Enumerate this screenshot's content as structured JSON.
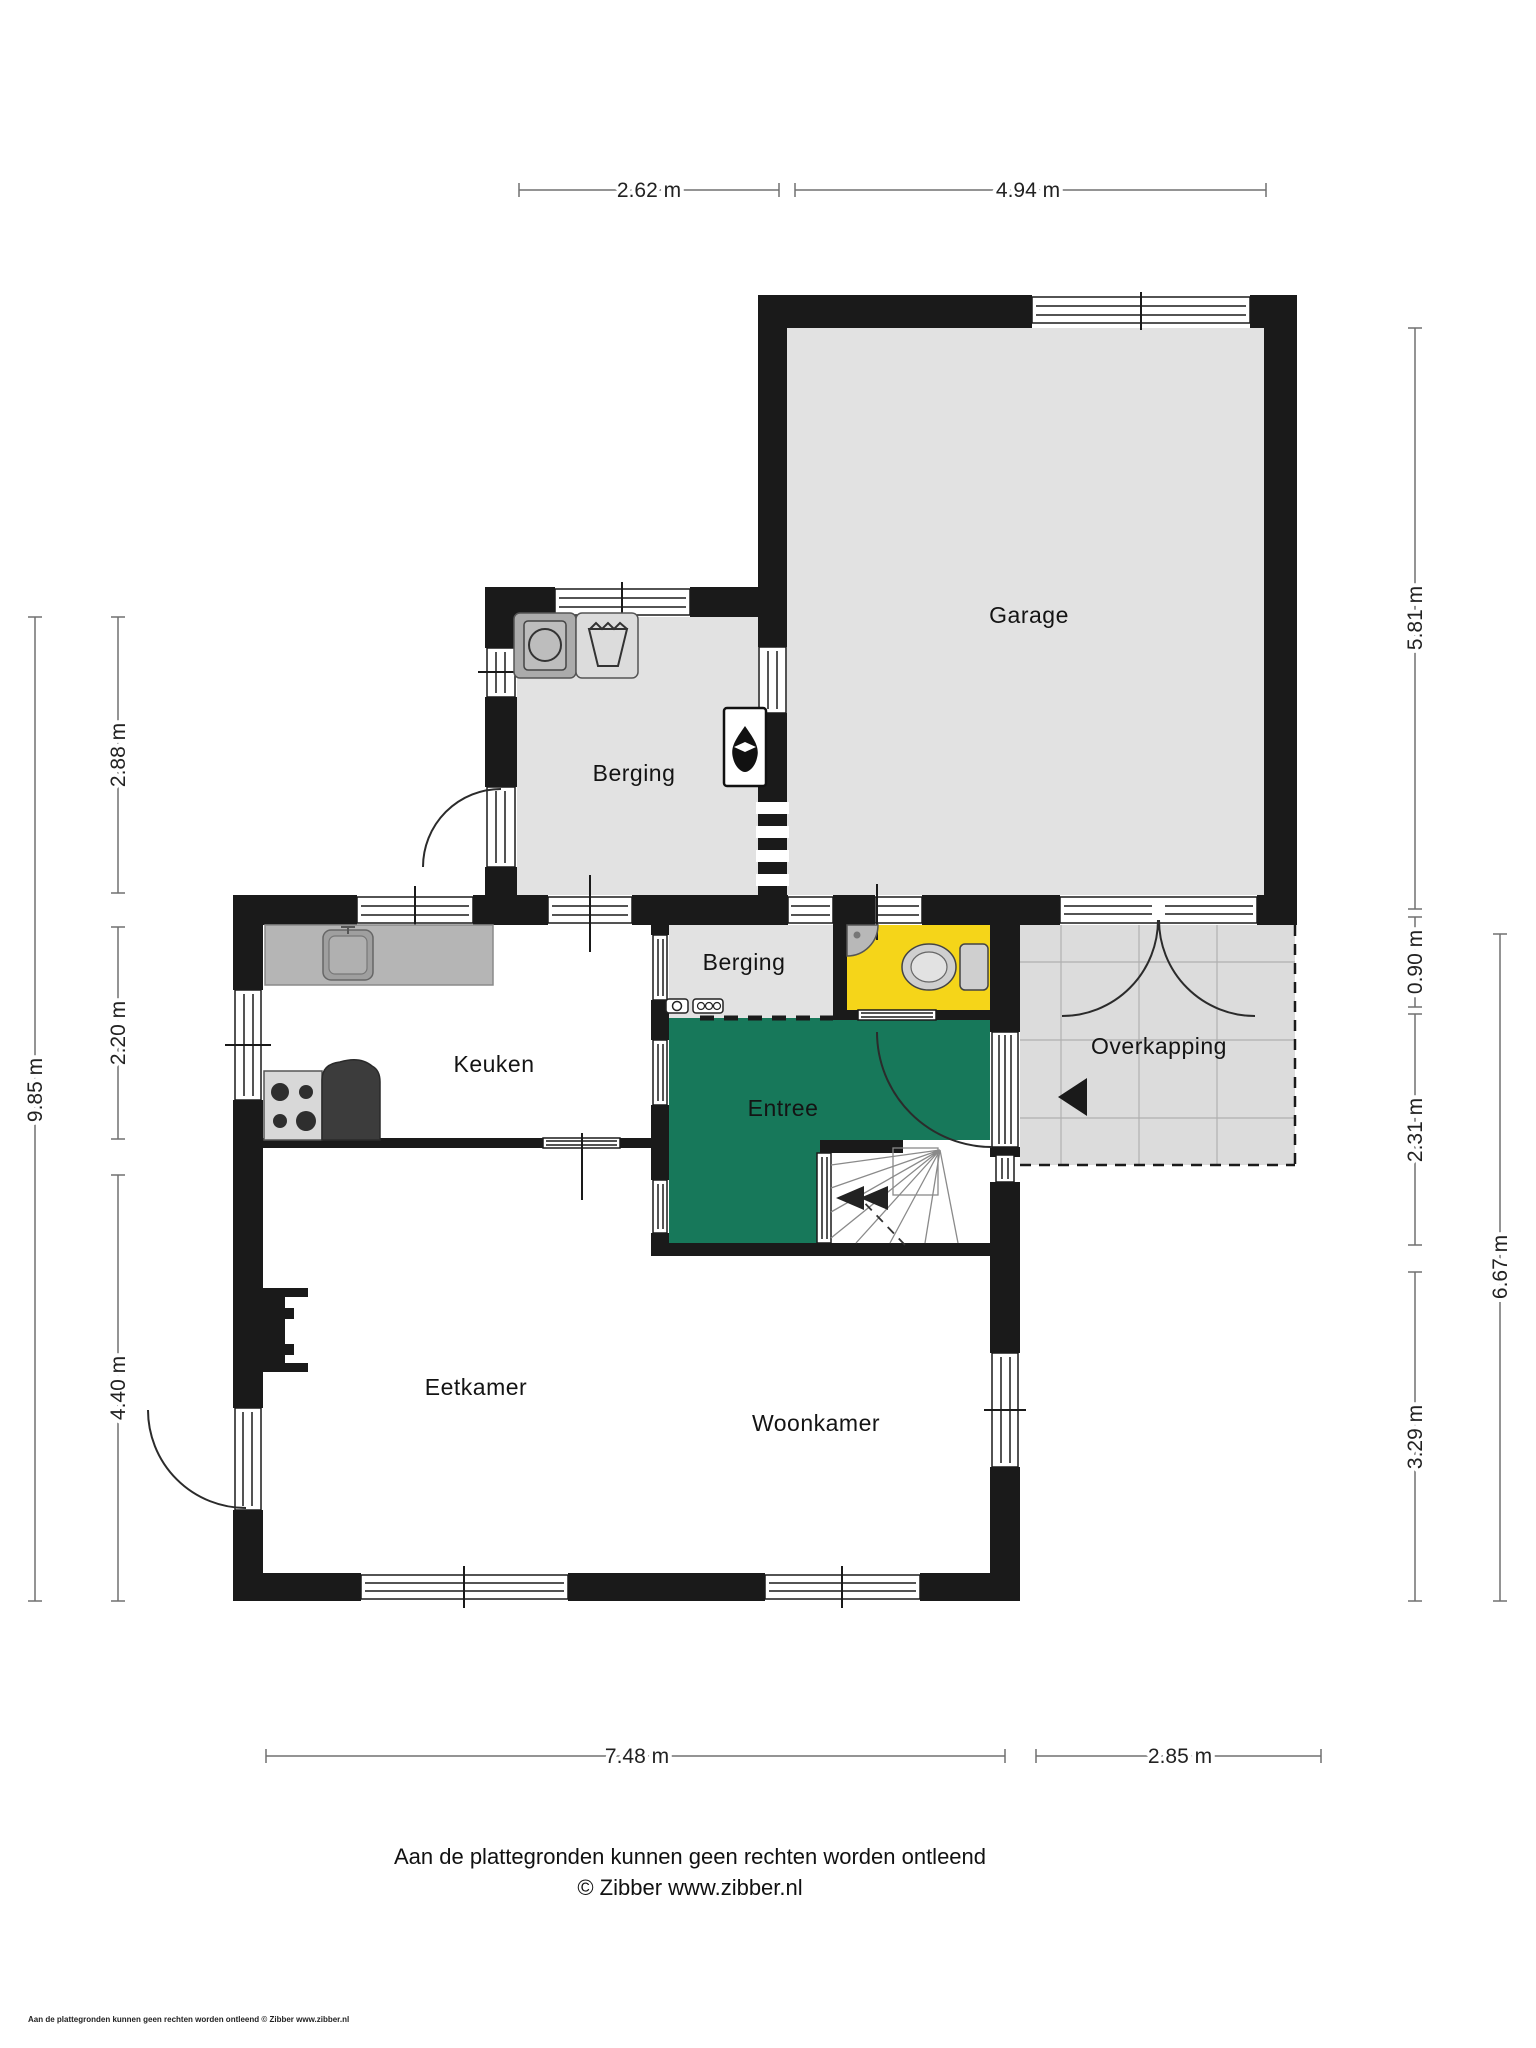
{
  "rooms": {
    "garage": "Garage",
    "berging": "Berging",
    "berging_klein": "Berging",
    "keuken": "Keuken",
    "entree": "Entree",
    "overkapping": "Overkapping",
    "eetkamer": "Eetkamer",
    "woonkamer": "Woonkamer"
  },
  "dimensions": {
    "top": [
      {
        "label": "2.62 m"
      },
      {
        "label": "4.94 m"
      }
    ],
    "left_inner": [
      {
        "label": "2.88 m"
      },
      {
        "label": "2.20 m"
      },
      {
        "label": "4.40 m"
      }
    ],
    "left_outer": {
      "label": "9.85 m"
    },
    "right_inner": [
      {
        "label": "5.81 m"
      },
      {
        "label": "0.90 m"
      },
      {
        "label": "2.31 m"
      },
      {
        "label": "3.29 m"
      }
    ],
    "right_outer": {
      "label": "6.67 m"
    },
    "bottom": [
      {
        "label": "7.48 m"
      },
      {
        "label": "2.85 m"
      }
    ]
  },
  "footer": {
    "disclaimer": "Aan de plattegronden kunnen geen rechten worden ontleend",
    "credit": "© Zibber www.zibber.nl",
    "corner_note": "Aan de plattegronden kunnen geen rechten worden ontleend © Zibber www.zibber.nl"
  },
  "icons": {
    "washer": "washing-machine-icon",
    "tub": "laundry-tub-icon",
    "sink": "kitchen-sink-icon",
    "stove": "stove-icon",
    "toilet": "toilet-icon",
    "corner_sink": "corner-sink-icon",
    "boiler": "boiler-flame-icon",
    "meters": "utility-meters-icon",
    "stairs": "stairs-icon",
    "entrance_arrow": "entrance-arrow-icon"
  },
  "colors": {
    "wall": "#1a1a1a",
    "floor": "#e2e2e2",
    "terrace": "#dcdcdc",
    "entree_green": "#17785a",
    "toilet_yellow": "#f5d519",
    "counter": "#b5b5b5"
  }
}
